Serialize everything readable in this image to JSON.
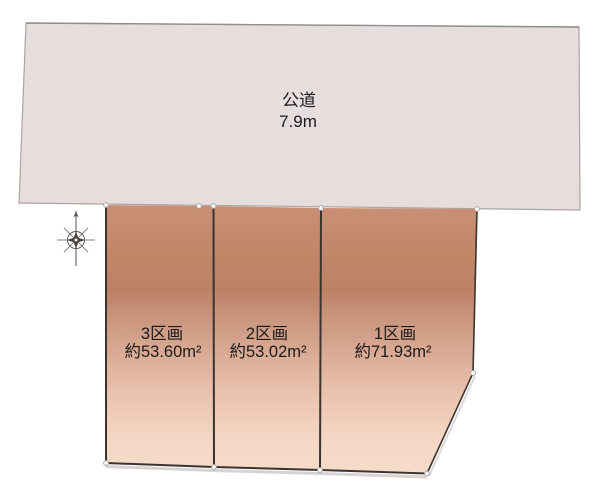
{
  "diagram": {
    "type": "land-plot-layout",
    "road": {
      "label": "公道",
      "width_label": "7.9m"
    },
    "plots": [
      {
        "name": "1区画",
        "area": "約71.93m²"
      },
      {
        "name": "2区画",
        "area": "約53.02m²"
      },
      {
        "name": "3区画",
        "area": "約53.60m²"
      }
    ],
    "icons": {
      "compass": "compass-rose"
    },
    "colors": {
      "road_fill": "#e5dedd",
      "road_stroke": "#aba4a2",
      "plot_gradient_top": "#ca9076",
      "plot_gradient_dark_band": "#bd8166",
      "plot_gradient_bottom": "#f7dcca",
      "plot_edge_stroke": "#3a3330",
      "vertex_dot_fill": "#ffffff",
      "text": "#1c1a19",
      "background": "#ffffff"
    }
  }
}
